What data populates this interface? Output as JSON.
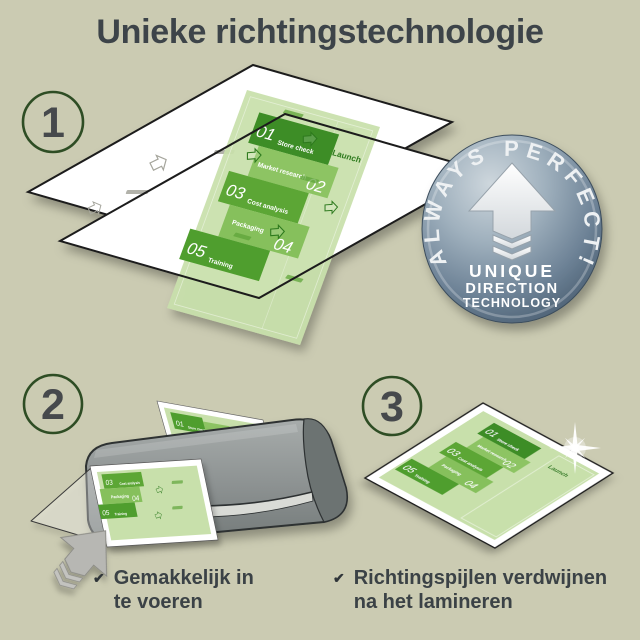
{
  "title": "Unieke richtingstechnologie",
  "steps": [
    {
      "number": "1"
    },
    {
      "number": "2"
    },
    {
      "number": "3"
    }
  ],
  "badge": {
    "arc_text": "ALWAYS PERFECT!",
    "line1": "UNIQUE",
    "line2": "DIRECTION",
    "line3": "TECHNOLOGY"
  },
  "document": {
    "launch_label": "Launch",
    "blocks": [
      {
        "num": "01",
        "label": "Store check"
      },
      {
        "num": "02",
        "label": "Market research"
      },
      {
        "num": "03",
        "label": "Cost analysis"
      },
      {
        "num": "04",
        "label": "Packaging"
      },
      {
        "num": "05",
        "label": "Training"
      }
    ]
  },
  "captions": {
    "check_glyph": "✔",
    "left_line1": "Gemakkelijk in",
    "left_line2": "te voeren",
    "right_line1": "Richtingspijlen verdwijnen",
    "right_line2": "na het lamineren"
  },
  "colors": {
    "background": "#cbcbb2",
    "title_text": "#3d4449",
    "step_circle_ring": "#2e4d24",
    "step_number": "#46494c",
    "doc_page_green": "#c8e0ab",
    "doc_green_dark": "#3e8d28",
    "doc_green_mid": "#5ca635",
    "doc_green_light": "#8dc463",
    "launch_green": "#2d7a1f",
    "badge_blue_gray": "#7c93a5",
    "laminator_gray": "#8f9494",
    "arrow_gray": "#b7b7b3"
  }
}
